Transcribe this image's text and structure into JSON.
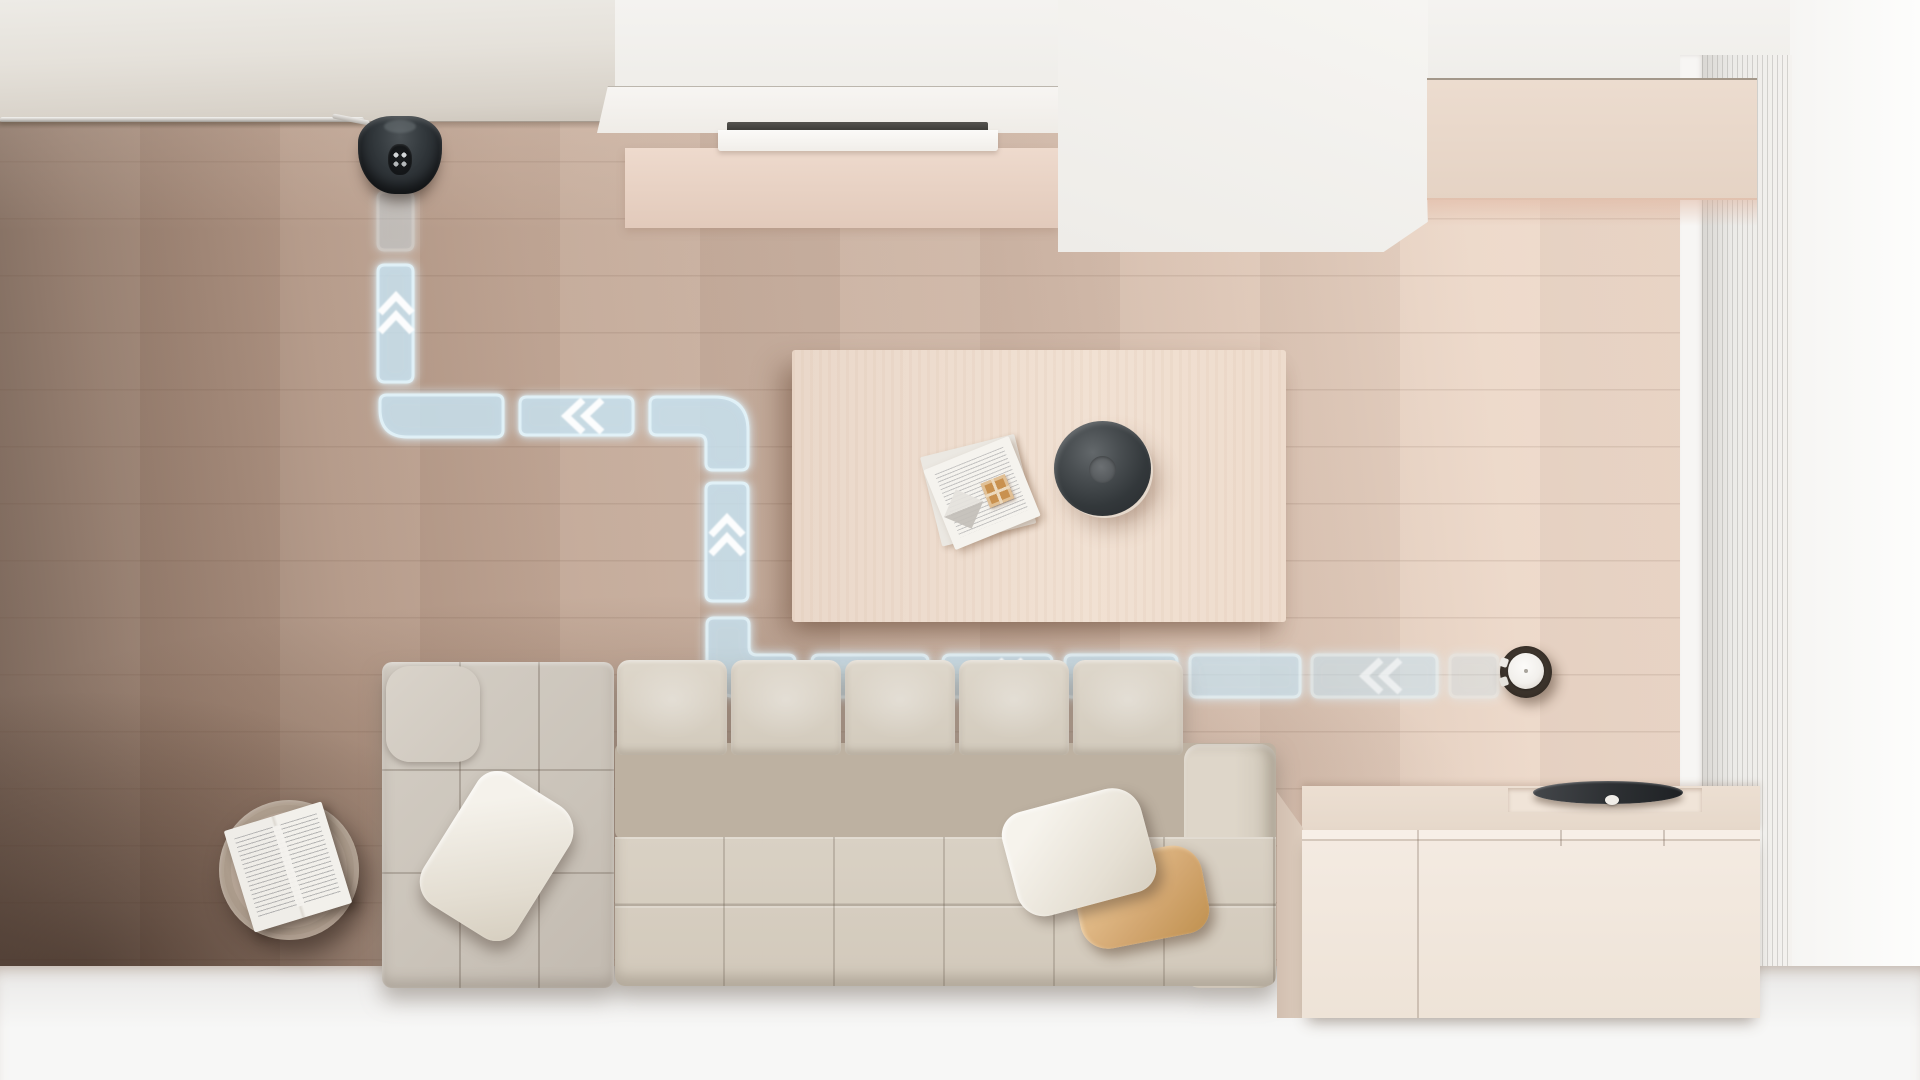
{
  "scene": {
    "title": "Robot vacuum cleaning route visualization",
    "setting": "Top-down 3D render of a living room with light wood flooring, modular sofa, coffee table and sideboard",
    "overlay": "Glowing blue dashed route with white direction arrows leading from the robot vacuum back to its charging dock"
  },
  "palette": {
    "route_fill": "rgba(173,212,233,0.42)",
    "route_stroke": "rgba(228,245,253,0.95)",
    "route_glow": "#cfeefc",
    "arrow_color": "#ffffff",
    "floor_dark": "#6f5b4f",
    "floor_mid": "#c9b1a1",
    "floor_light": "#f1ddce",
    "table_wood": "#eeddd0",
    "sofa_fabric": "#d5cec2",
    "pillow_tan": "#d3a771",
    "cabinet_wood": "#f2e8de",
    "device_dark": "#2b2f31",
    "white_floor": "#f2f1f0"
  },
  "route": {
    "segments": [
      {
        "id": "dock-approach",
        "kind": "rect",
        "x": 378,
        "y": 192,
        "w": 35,
        "h": 58,
        "opacity": 0.45
      },
      {
        "id": "up-to-dock",
        "kind": "rect",
        "x": 378,
        "y": 265,
        "w": 35,
        "h": 117,
        "opacity": 0.95
      },
      {
        "id": "turn-left-up",
        "kind": "corner_bl",
        "x": 380,
        "y": 395,
        "w": 123,
        "h": 42,
        "opacity": 0.95
      },
      {
        "id": "mid-row-1",
        "kind": "rect",
        "x": 520,
        "y": 397,
        "w": 113,
        "h": 38,
        "opacity": 0.95
      },
      {
        "id": "turn-up-to-left",
        "kind": "elbow_tr",
        "x": 650,
        "y": 397,
        "w": 98,
        "h": 73,
        "opacity": 0.95
      },
      {
        "id": "mid-vertical",
        "kind": "rect",
        "x": 706,
        "y": 483,
        "w": 42,
        "h": 118,
        "opacity": 0.95
      },
      {
        "id": "turn-left-to-up",
        "kind": "elbow_bl",
        "x": 707,
        "y": 618,
        "w": 88,
        "h": 79,
        "opacity": 0.92
      },
      {
        "id": "bottom-row-1",
        "kind": "rect",
        "x": 812,
        "y": 655,
        "w": 116,
        "h": 42,
        "opacity": 0.9
      },
      {
        "id": "bottom-row-2",
        "kind": "rect",
        "x": 943,
        "y": 655,
        "w": 109,
        "h": 42,
        "opacity": 0.9
      },
      {
        "id": "bottom-row-3",
        "kind": "rect",
        "x": 1065,
        "y": 655,
        "w": 112,
        "h": 42,
        "opacity": 0.88
      },
      {
        "id": "bottom-row-4",
        "kind": "rect",
        "x": 1190,
        "y": 655,
        "w": 110,
        "h": 42,
        "opacity": 0.8
      },
      {
        "id": "bottom-row-5",
        "kind": "rect",
        "x": 1312,
        "y": 655,
        "w": 125,
        "h": 42,
        "opacity": 0.65
      },
      {
        "id": "robot-start",
        "kind": "rect",
        "x": 1450,
        "y": 655,
        "w": 48,
        "h": 42,
        "opacity": 0.4
      }
    ],
    "arrows": [
      {
        "dir": "up",
        "x": 396,
        "y": 307,
        "opacity": 0.95
      },
      {
        "dir": "left",
        "x": 577,
        "y": 416,
        "opacity": 0.95
      },
      {
        "dir": "up",
        "x": 727,
        "y": 529,
        "opacity": 0.95
      },
      {
        "dir": "left",
        "x": 998,
        "y": 676,
        "opacity": 0.9
      },
      {
        "dir": "left",
        "x": 1375,
        "y": 676,
        "opacity": 0.6
      }
    ]
  },
  "objects": {
    "charging_dock": {
      "label": "charging dock against wall",
      "cx": 400,
      "cy": 155
    },
    "power_cable": {
      "label": "power cable running along wall base"
    },
    "robot_vacuum": {
      "label": "round robot vacuum with white dome",
      "cx": 1526,
      "cy": 672
    },
    "coffee_table": {
      "label": "light wooden coffee table"
    },
    "bowl": {
      "label": "dark round decorative bowl on table"
    },
    "papers": {
      "label": "open magazine with chocolate box on table"
    },
    "sofa": {
      "label": "modular tufted sofa with chaise"
    },
    "pillows": [
      "white throw pillow left",
      "white throw pillow right",
      "tan throw pillow"
    ],
    "side_table": {
      "label": "round wooden side table with open book"
    },
    "sideboard": {
      "label": "low light-wood sideboard"
    },
    "speaker_disc": {
      "label": "dark disc device on sideboard"
    },
    "vent": {
      "label": "recessed vent slot in white console"
    },
    "wood_wall_panel": {
      "label": "light wood wall panel top right"
    },
    "slatted_panel": {
      "label": "white slatted panel on right wall"
    }
  }
}
